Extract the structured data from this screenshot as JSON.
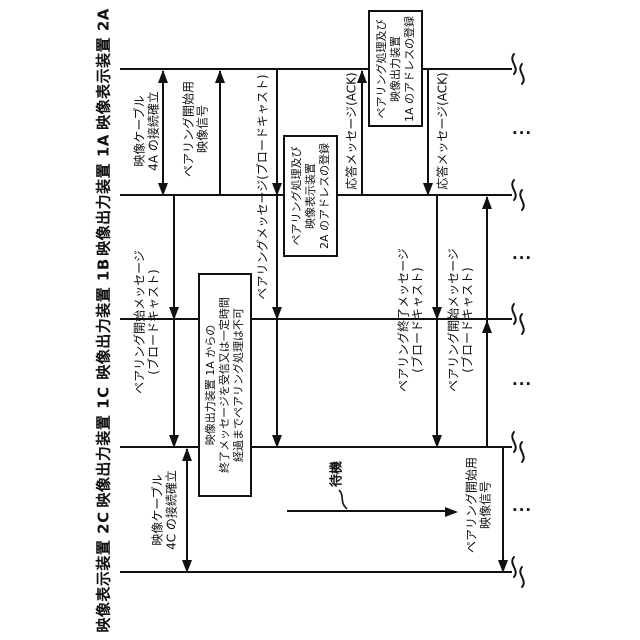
{
  "figure": {
    "kind": "patent-style pairing sequence diagram (rotated 90°)",
    "background_color": "#ffffff",
    "ink_color": "#111111"
  },
  "participants": [
    {
      "id": "2A",
      "label": "映像表示装置 2A",
      "y": 69
    },
    {
      "id": "1A",
      "label": "映像出力装置 1A",
      "y": 195
    },
    {
      "id": "1B",
      "label": "映像出力装置 1B",
      "y": 319
    },
    {
      "id": "1C",
      "label": "映像出力装置 1C",
      "y": 447
    },
    {
      "id": "2C",
      "label": "映像表示装置 2C",
      "y": 572
    }
  ],
  "lifeline": {
    "x1": 120,
    "x2": 512,
    "label_x": 104,
    "break_x": 505
  },
  "messages": [
    {
      "name": "cable-4a-connect",
      "x": 163,
      "y1": 71,
      "y2": 193,
      "heads": [
        {
          "y": 69,
          "dir": "up"
        },
        {
          "y": 195,
          "dir": "down"
        }
      ],
      "label": {
        "x": 147,
        "y": 131,
        "lines": [
          "映像ケーブル",
          "4A の接続確立"
        ]
      }
    },
    {
      "name": "pairing-start-video-a",
      "x": 220,
      "y1": 71,
      "y2": 195,
      "heads": [
        {
          "y": 69,
          "dir": "up"
        }
      ],
      "label": {
        "x": 196,
        "y": 129,
        "lines": [
          "ペアリング開始用",
          "映像信号"
        ]
      }
    },
    {
      "name": "pairing-start-msg-1a",
      "x": 174,
      "y1": 195,
      "y2": 445,
      "heads": [
        {
          "y": 319,
          "dir": "down"
        },
        {
          "y": 447,
          "dir": "down"
        }
      ],
      "label": {
        "x": 147,
        "y": 322,
        "lines": [
          "ペアリング開始メッセージ",
          "(ブロードキャスト)"
        ]
      }
    },
    {
      "name": "pairing-msg-2a",
      "x": 277,
      "y1": 69,
      "y2": 445,
      "heads": [
        {
          "y": 195,
          "dir": "down"
        },
        {
          "y": 319,
          "dir": "down"
        },
        {
          "y": 447,
          "dir": "down"
        }
      ],
      "label": {
        "x": 263,
        "y": 187,
        "lines": [
          "ペアリングメッセージ(ブロードキャスト)"
        ]
      }
    },
    {
      "name": "ack-1a-to-2a",
      "x": 362,
      "y1": 71,
      "y2": 195,
      "heads": [
        {
          "y": 69,
          "dir": "up"
        }
      ],
      "label": {
        "x": 352,
        "y": 131,
        "lines": [
          "応答メッセージ(ACK)"
        ]
      }
    },
    {
      "name": "ack-2a-to-1a",
      "x": 428,
      "y1": 69,
      "y2": 193,
      "heads": [
        {
          "y": 195,
          "dir": "down"
        }
      ],
      "label": {
        "x": 443,
        "y": 131,
        "lines": [
          "応答メッセージ(ACK)"
        ]
      }
    },
    {
      "name": "pairing-end-msg-1a",
      "x": 437,
      "y1": 195,
      "y2": 445,
      "heads": [
        {
          "y": 319,
          "dir": "down"
        },
        {
          "y": 447,
          "dir": "down"
        }
      ],
      "label": {
        "x": 411,
        "y": 320,
        "lines": [
          "ペアリング終了メッセージ",
          "(ブロードキャスト)"
        ]
      }
    },
    {
      "name": "pairing-start-msg-1c",
      "x": 487,
      "y1": 197,
      "y2": 447,
      "heads": [
        {
          "y": 195,
          "dir": "up"
        },
        {
          "y": 319,
          "dir": "up"
        }
      ],
      "label": {
        "x": 461,
        "y": 320,
        "lines": [
          "ペアリング開始メッセージ",
          "(ブロードキャスト)"
        ]
      }
    },
    {
      "name": "pairing-start-video-c",
      "x": 503,
      "y1": 447,
      "y2": 570,
      "heads": [
        {
          "y": 572,
          "dir": "down"
        }
      ],
      "label": {
        "x": 479,
        "y": 505,
        "lines": [
          "ペアリング開始用",
          "映像信号"
        ]
      }
    },
    {
      "name": "cable-4c-connect",
      "x": 187,
      "y1": 449,
      "y2": 570,
      "heads": [
        {
          "y": 447,
          "dir": "up"
        },
        {
          "y": 572,
          "dir": "down"
        }
      ],
      "label": {
        "x": 165,
        "y": 510,
        "lines": [
          "映像ケーブル",
          "4C の接続確立"
        ]
      }
    }
  ],
  "boxes": [
    {
      "name": "process-box-2a",
      "x": 368,
      "y": 10,
      "w": 55,
      "h": 117,
      "lines": [
        "ペアリング処理及び",
        "映像出力装置",
        "1A のアドレスの登録"
      ]
    },
    {
      "name": "process-box-1a",
      "x": 283,
      "y": 135,
      "w": 55,
      "h": 122,
      "lines": [
        "ペアリング処理及び",
        "映像表示装置",
        "2A のアドレスの登録"
      ]
    },
    {
      "name": "pairing-restriction-note",
      "x": 198,
      "y": 273,
      "w": 54,
      "h": 224,
      "lines": [
        "映像出力装置 1A からの",
        "終了メッセージを受信又は一定時間",
        "経過までペアリング処理は不可"
      ]
    }
  ],
  "standby": {
    "label": "待機",
    "label_x": 335,
    "label_y": 474,
    "line_y": 511,
    "x1": 287,
    "x2": 445
  },
  "continuation_dots": [
    {
      "x": 512,
      "y": 132
    },
    {
      "x": 512,
      "y": 257
    },
    {
      "x": 512,
      "y": 383
    },
    {
      "x": 512,
      "y": 509
    }
  ],
  "dots_glyph": "..."
}
